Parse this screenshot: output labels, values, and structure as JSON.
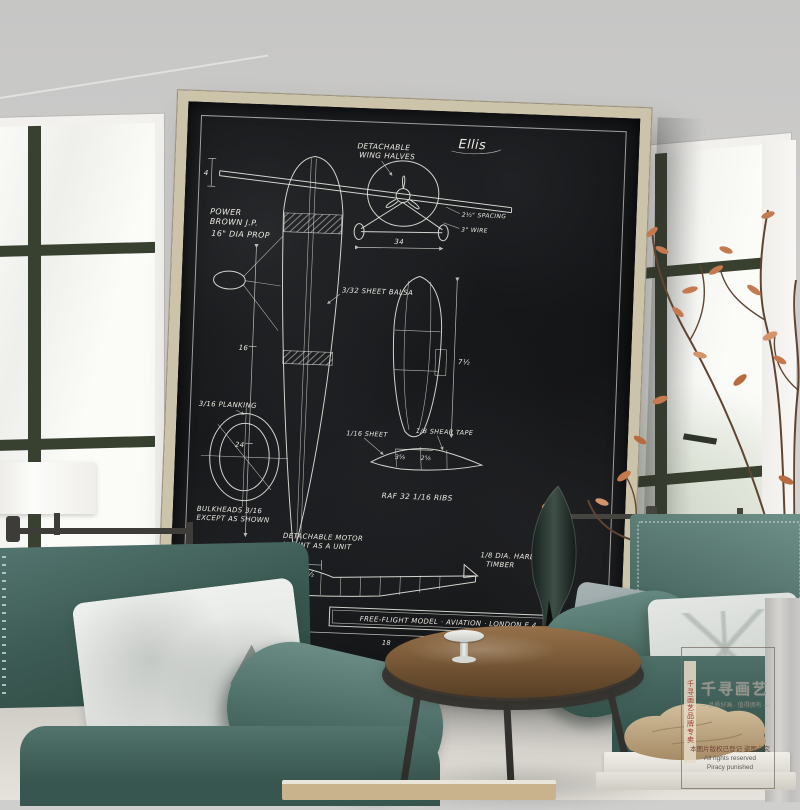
{
  "poster": {
    "signature": "Ellis",
    "labels": {
      "detachable_1": "DETACHABLE",
      "detachable_2": "WING HALVES",
      "power_1": "POWER",
      "power_2": "BROWN J.P.",
      "power_3": "16\" DIA PROP",
      "spacing": "2½\" SPACING",
      "wire": "3\" WIRE",
      "balsa": "3/32 SHEET BALSA",
      "planking": "3/16 PLANKING",
      "bulkheads_1": "BULKHEADS 3/16",
      "bulkheads_2": "EXCEPT AS SHOWN",
      "sheet": "1/16 SHEET",
      "shear": "1/8 SHEAR TAPE",
      "raf": "RAF 32   1/16 RIBS",
      "motor_1": "DETACHABLE MOTOR",
      "motor_2": "MOUNT AS A UNIT",
      "timber_1": "1/8 DIA. HARD",
      "timber_2": "TIMBER",
      "wheel": "4\" WHEEL",
      "title_block": "FREE-FLIGHT  MODEL · AVIATION · LONDON E.4"
    },
    "dims": {
      "span": "34",
      "d16": "16",
      "d24": "24",
      "d7": "7",
      "d65": "6½",
      "d75": "7½",
      "d18": "18",
      "d15": "1½",
      "d4": "4",
      "d35": "3⅝",
      "d25": "2⅝"
    }
  },
  "watermark": {
    "brand": "千寻画艺",
    "tagline": "— 品质好画 · 值得拥有 —",
    "side_stamp": "千寻画艺品牌专卖",
    "notice_cn": "本图片版权已登记 盗图必究",
    "notice_en1": "All rights reserved",
    "notice_en2": "Piracy punished"
  },
  "colors": {
    "wall": "#cfcfce",
    "poster_frame": "#ccc3ab",
    "poster_canvas": "#101113",
    "blueprint_line": "#e8e8e2",
    "chair_velvet": "#3f5d55",
    "pillow": "#e3e6e3",
    "table_top": "#7a5a38",
    "mullion": "#38402f",
    "leaves_rust": "#c47a4e",
    "rock": "#c3ae8c",
    "curtain": "#c7c6c4"
  }
}
